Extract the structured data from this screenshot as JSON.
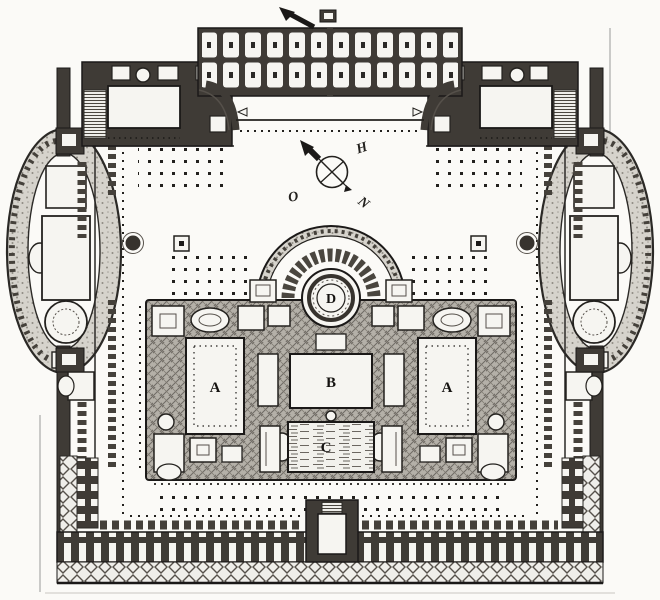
{
  "plan": {
    "room_labels": {
      "hall_a_left": "A",
      "hall_a_right": "A",
      "central_hall_b": "B",
      "pool_c": "C",
      "rotunda_d": "D"
    },
    "compass": {
      "letter_upper_right": "H",
      "letter_lower_left": "O",
      "letter_lower_right": "N"
    },
    "colors": {
      "paper": "#fbfaf7",
      "ink": "#1b1918",
      "wall_poche": "#3f3b36",
      "block_texture": "#b4b0a8"
    },
    "icons": {
      "compass_arrow": "north-arrow-icon",
      "top_marker": "entrance-arrow-icon"
    }
  }
}
